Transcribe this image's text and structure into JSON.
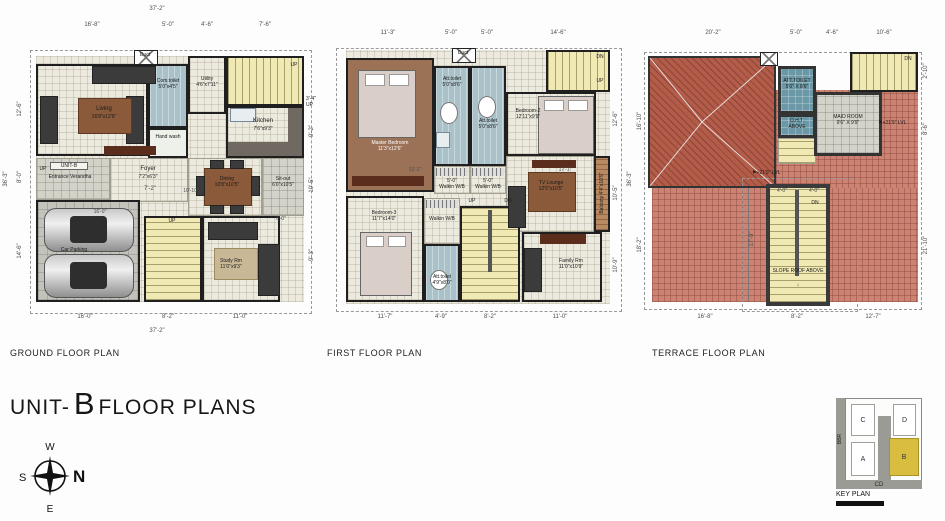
{
  "sheet": {
    "title_prefix": "UNIT-",
    "title_unit": "B",
    "title_suffix": "FLOOR PLANS"
  },
  "glyphs": {
    "up": "↑",
    "down": "↓",
    "flag": "⚑"
  },
  "ground": {
    "name": "GROUND FLOOR PLAN",
    "dims": {
      "top_overall": "37'-2\"",
      "top": [
        "16'-8\"",
        "5'-0\"",
        "4'-6\"",
        "7'-6\""
      ],
      "left_overall": "36'-3\"",
      "left": [
        "12'-6\"",
        "8'-0\"",
        "14'-6\""
      ],
      "bottom": [
        "16'-0\"",
        "8'-2\"",
        "11'-0\""
      ],
      "bottom_overall": "37'-2\"",
      "right": [
        "9'-2\"",
        "10'-5\"",
        "9'-3\""
      ],
      "inner_foyer": "7'-2\"",
      "inner_dining": "10'-10\"",
      "inner_parking": "16'-0\"",
      "inner_sitout": "6'-0\"",
      "stair_side": "3'-4\"",
      "stair_side_up": "UP"
    },
    "rooms": {
      "living": {
        "name": "Living",
        "size": "16'8\"x12'6\""
      },
      "com_toilet": {
        "name": "Com.toilet",
        "size": "5'0\"x4'5\""
      },
      "hand_wash": {
        "name": "Hand wash"
      },
      "duct": {
        "name": "Duct"
      },
      "utility": {
        "name": "Utility",
        "size": "4'6\"x7'11\""
      },
      "kitchen": {
        "name": "Kitchen",
        "size": "7'6\"x9'3\""
      },
      "stairs": {
        "up": "UP"
      },
      "verandha": {
        "unit": "UNIT-B",
        "name": "Entrance Verandha",
        "up": "UP"
      },
      "foyer": {
        "name": "Foyer",
        "size": "7'2\"x6'3\""
      },
      "dining": {
        "name": "Dining",
        "size": "10'8\"x10'5\""
      },
      "sitout": {
        "name": "Sit-out",
        "size": "6'0\"x10'5\""
      },
      "car_parking": {
        "name": "Car Parking"
      },
      "stairs2": {
        "up": "UP"
      },
      "study": {
        "name": "Study Rm",
        "size": "11'0\"x9'3\""
      }
    }
  },
  "first": {
    "name": "FIRST FLOOR PLAN",
    "dims": {
      "top": [
        "11'-3\"",
        "5'-0\"",
        "5'-0\"",
        "14'-6\""
      ],
      "bottom": [
        "11'-7\"",
        "4'-9\"",
        "8'-2\"",
        "11'-0\""
      ],
      "right": [
        "12'-6\"",
        "10'-5\"",
        "10'-9\""
      ],
      "right_overall": "36'-3\"",
      "inner_left": "13'-2\"",
      "inner_right": "17'-1\"",
      "walkin1": "5'-0\"",
      "walkin2": "5'-0\""
    },
    "rooms": {
      "master": {
        "name": "Master Bedroom",
        "size": "11'3\"x12'6\""
      },
      "att_toilet1": {
        "name": "Att.toilet",
        "size": "5'0\"x8'6\""
      },
      "duct": {
        "name": "Duct"
      },
      "att_toilet2": {
        "name": "Att.toilet",
        "size": "5'0\"x8'6\""
      },
      "walkin1": {
        "name": "Walkin W/B"
      },
      "walkin2": {
        "name": "Walkin W/B"
      },
      "bedroom2": {
        "name": "Bedroom-2",
        "size": "12'11\"x9'9\""
      },
      "stairs_top": {
        "dn": "DN",
        "up": "UP"
      },
      "tv_lounge": {
        "name": "TV Lounge",
        "size": "12'5\"x10'5\""
      },
      "balcony": {
        "name": "Balcony",
        "size": "4'4\"x10'5\""
      },
      "bedroom3": {
        "name": "Bedroom-3",
        "size": "11'7\"x14'0\""
      },
      "walkin3": {
        "name": "Walkin W/B"
      },
      "att_toilet3": {
        "name": "Att.toilet",
        "size": "4'9\"x8'0\""
      },
      "stairs_mid": {
        "up": "UP",
        "dn": "DN"
      },
      "family": {
        "name": "Family Rm",
        "size": "11'0\"x10'9\""
      }
    }
  },
  "terrace": {
    "name": "TERRACE FLOOR PLAN",
    "dims": {
      "top": [
        "20'-2\"",
        "5'-0\"",
        "4'-6\"",
        "10'-6\""
      ],
      "bottom": [
        "16'-8\"",
        "8'-2\"",
        "12'-7\""
      ],
      "left": [
        "16'-10\"",
        "18'-2\""
      ],
      "right": [
        "2'-10\"",
        "8'-6\"",
        "21'-10\""
      ],
      "inner_stair": "17'-9\"",
      "stair_w1": "4'-0\"",
      "stair_w2": "4'-0\""
    },
    "rooms": {
      "att_toilet": {
        "name": "ATT.TOILET",
        "size": "5'0\" X 8'6\""
      },
      "oht": {
        "name": "O.H.T.",
        "name2": "ABOVE"
      },
      "maid": {
        "name": "MAID ROOM",
        "size": "9'6\" X 9'9\""
      },
      "stairs_top": {
        "dn": "DN"
      },
      "stair_block": {
        "dn": "DN",
        "note": "SLOPE ROOF ABOVE"
      },
      "lvl_a": "+21'9\" LVL",
      "lvl_b": "+21'9\" LVL"
    }
  },
  "compass": {
    "n": "N",
    "w": "W",
    "s": "S",
    "e": "E"
  },
  "key_plan": {
    "title": "KEY PLAN",
    "left_road": "BBR",
    "bottom_road": "CD",
    "unit_a": "A",
    "unit_b": "B",
    "unit_c": "C",
    "unit_d": "D"
  },
  "colors": {
    "wall": "#1c1c1c",
    "stairs": "#f1e9b4",
    "toilet_blue": "#a9c2ca",
    "toilet_teal": "#6b98a6",
    "bedroom_brown": "#9c7257",
    "terrace_brick": "#cd8373",
    "roof_red": "#b45c4a",
    "unit_highlight": "#d9bd3f"
  }
}
